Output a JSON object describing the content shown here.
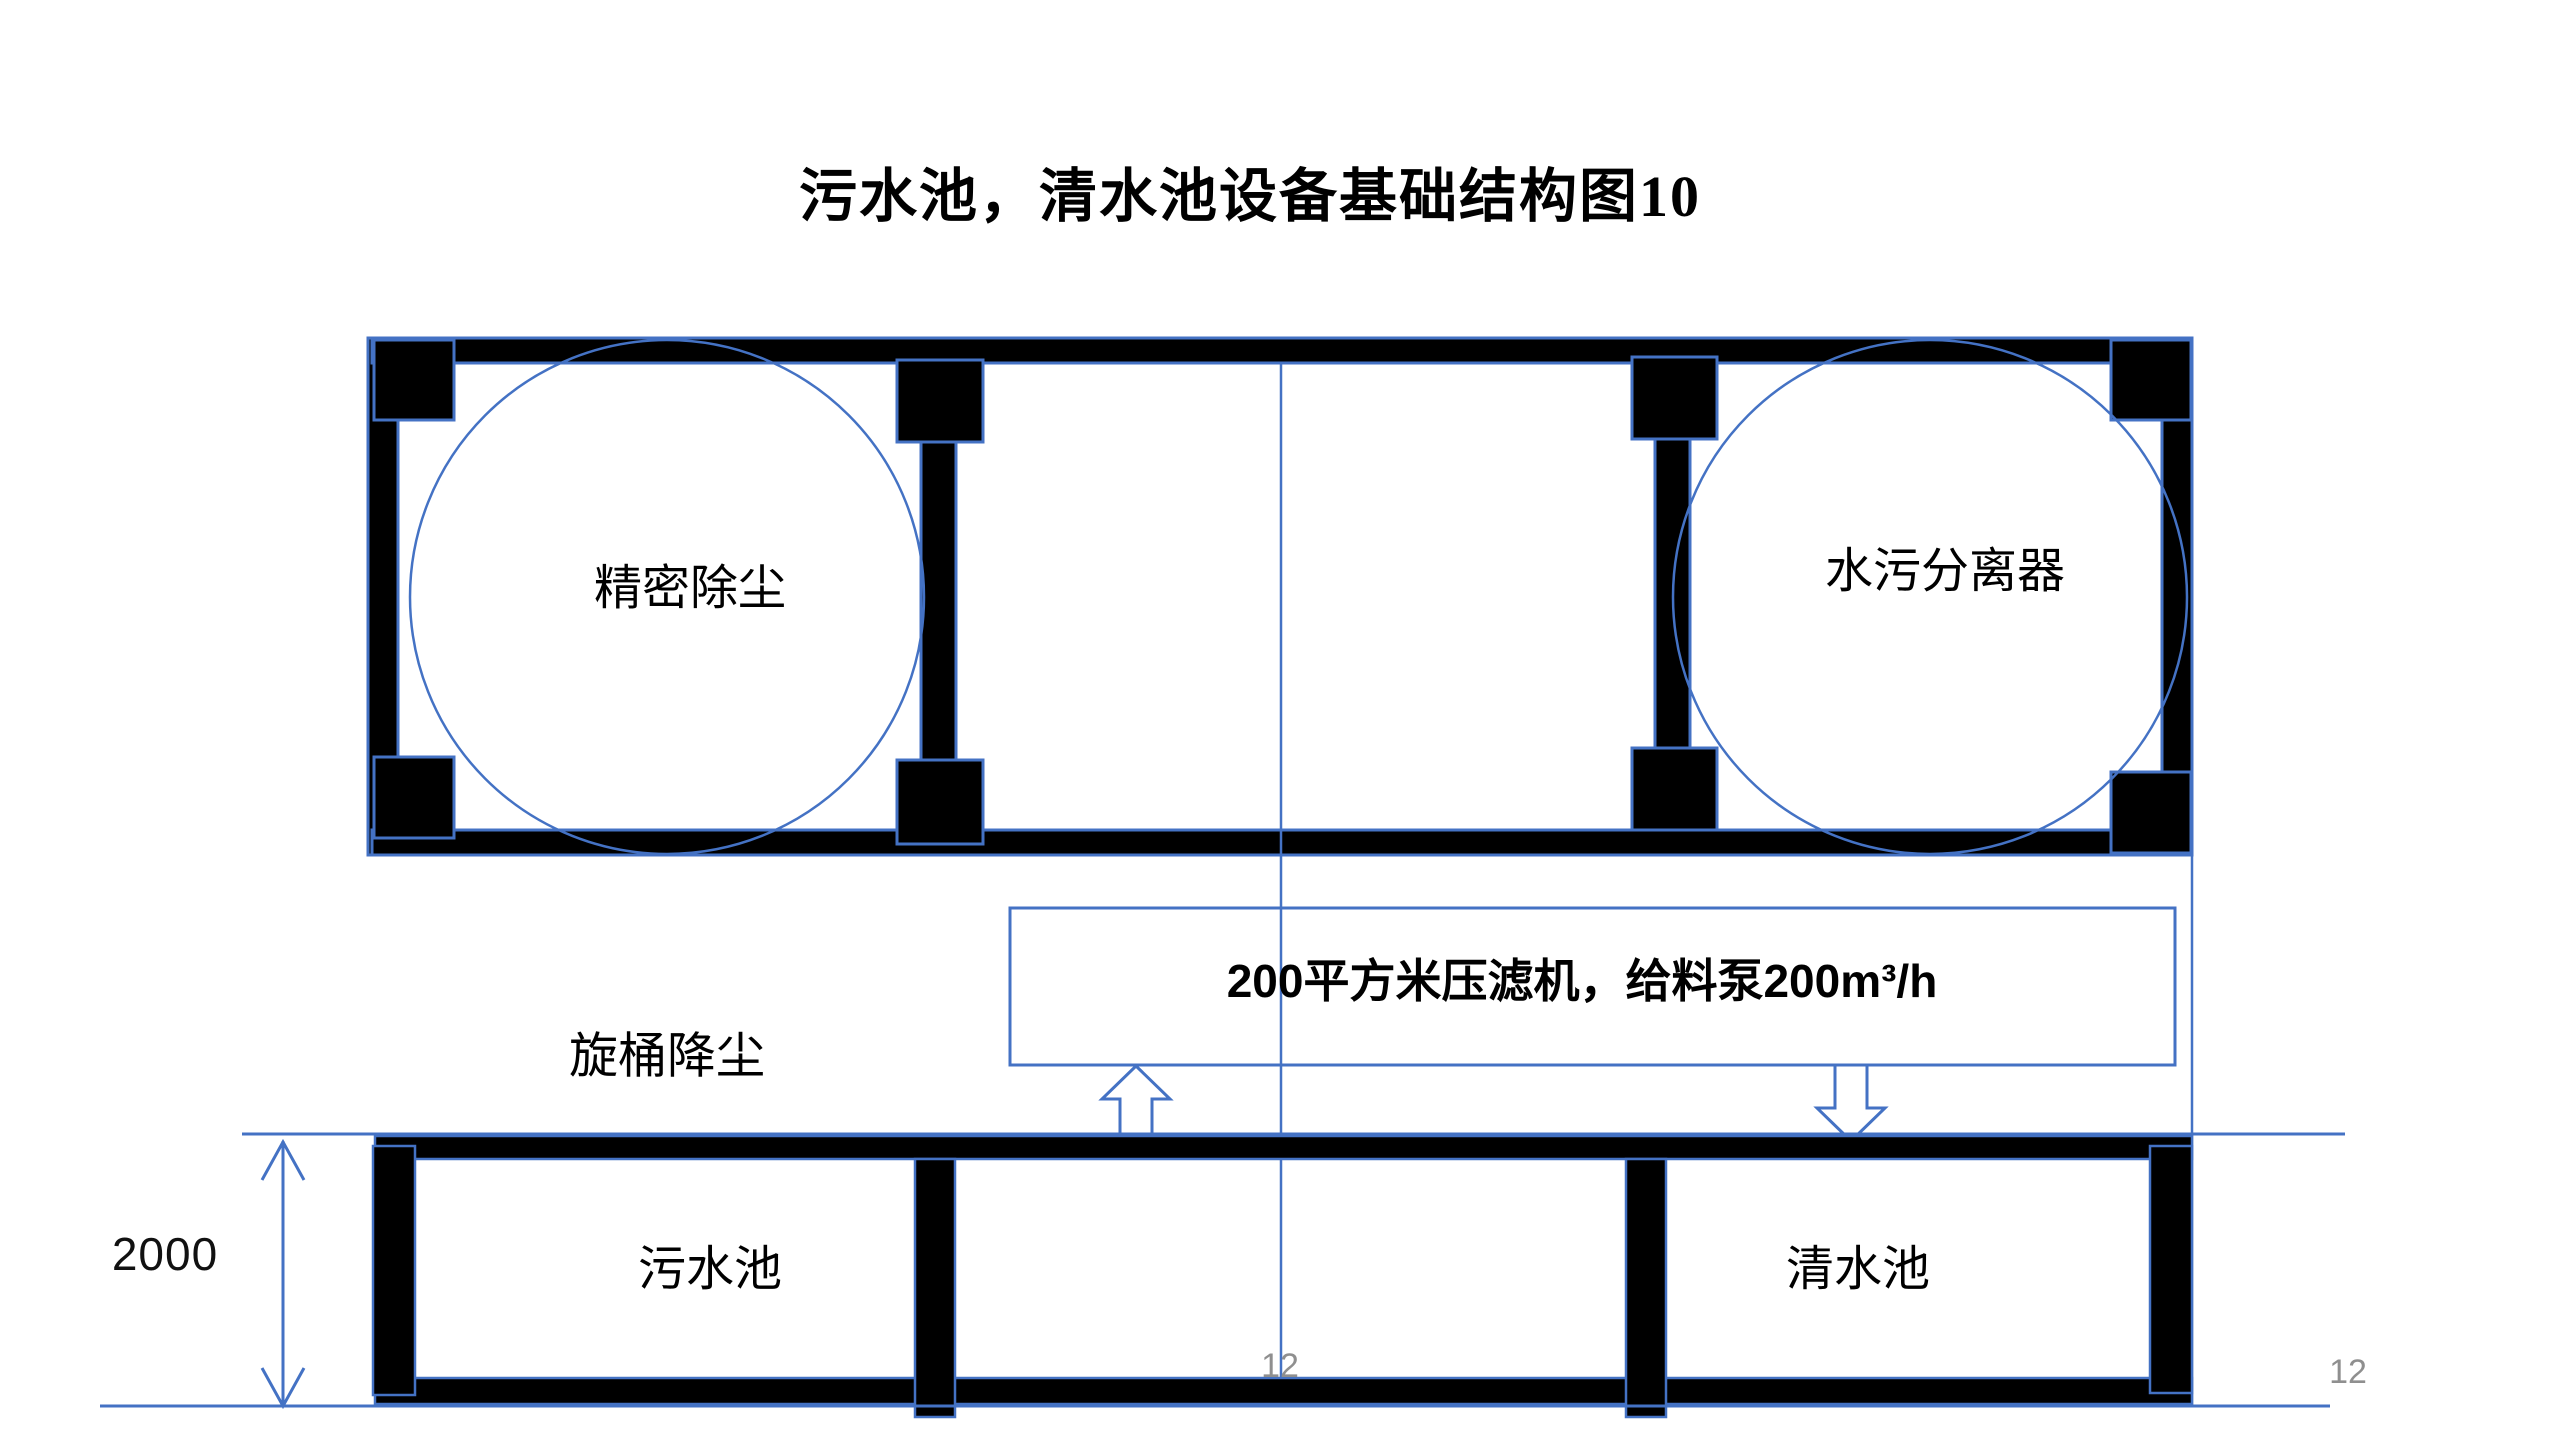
{
  "slide": {
    "title": "污水池，清水池设备基础结构图10",
    "page_number_center": "12",
    "page_number_right": "12"
  },
  "plan_view": {
    "left_vessel_label": "精密除尘",
    "right_vessel_label": "水污分离器"
  },
  "equipment_note": {
    "label": "200平方米压滤机，给料泵200m³/h"
  },
  "section_view": {
    "dust_reduction_label": "旋桶降尘",
    "sewage_pool_label": "污水池",
    "clean_water_pool_label": "清水池",
    "depth_dimension_mm": "2000"
  },
  "colors": {
    "accent_blue": "#4472C4",
    "structure_black": "#000000",
    "page_number_gray": "#8F8F8F",
    "background": "#FFFFFF"
  }
}
